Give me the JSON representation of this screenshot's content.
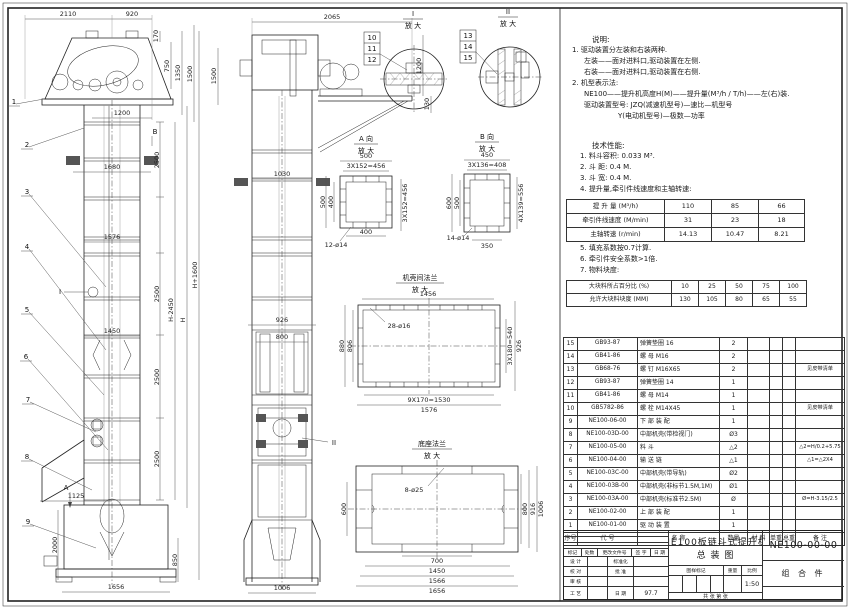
{
  "sheet": {
    "title_line1": "NE100板链斗式提升机",
    "title_line2": "总  装  图",
    "drawing_no": "NE100-00-00",
    "part_type": "组 合 件",
    "scale": "1:50",
    "date": "97.7",
    "sheet_info": "共  张  第  张"
  },
  "labels": {
    "fangda": "放 大",
    "viewA": "A 向",
    "viewB": "B 向",
    "flangeDetail": "机壳间法兰",
    "baseDetail": "底座法兰",
    "secI": "I",
    "secII": "II",
    "lA": "A",
    "lB": "B"
  },
  "callouts": {
    "c1": "1",
    "c2": "2",
    "c3": "3",
    "c4": "4",
    "c5": "5",
    "c6": "6",
    "c7": "7",
    "c8": "8",
    "c9": "9",
    "c10": "10",
    "c11": "11",
    "c12": "12",
    "c13": "13",
    "c14": "14",
    "c15": "15"
  },
  "dims": {
    "d2110": "2110",
    "d920": "920",
    "d170": "170",
    "d750": "750",
    "d1350": "1350",
    "d1500": "1500",
    "d1200": "1200",
    "d1680": "1680",
    "d2500": "2500",
    "d1576": "1576",
    "d1450": "1450",
    "dHm": "H-2450",
    "dH": "H",
    "dHp": "H+1600",
    "d1125": "1125",
    "d2000": "2000",
    "d850": "850",
    "d1656": "1656",
    "d2065": "2065",
    "d130": "130",
    "d1030": "1030",
    "d926": "926",
    "d800": "800",
    "d1006": "1006",
    "d500": "500",
    "d3x152": "3X152=456",
    "d400": "400",
    "d12o14": "12-ø14",
    "d450": "450",
    "d3x136": "3X136=408",
    "d600": "600",
    "d4x139": "4X139=556",
    "d14o14": "14-ø14",
    "d350": "350",
    "d1456": "1456",
    "d28o16": "28-ø16",
    "d880": "880",
    "d806": "806",
    "d3x180": "3X180=540",
    "d9x170": "9X170=1530",
    "d8o25": "8-ø25",
    "d916": "916",
    "d700": "700",
    "d1566": "1566"
  },
  "notes": {
    "heading": "说明:",
    "lines": [
      "1. 驱动装置分左装和右装两种.",
      "左装——面对进料口,驱动装置在左侧.",
      "右装——面对进料口,驱动装置在右侧.",
      "2. 机型表示法:",
      "NE100——提升机高度H(M)——提升量(M³/h / T/h)——左(右)装.",
      "驱动装置型号: JZQ(减速机型号)—速比—机型号",
      "Y(电动机型号)—极数—功率"
    ]
  },
  "specs": {
    "heading": "技术性能:",
    "items_a": [
      "1. 料斗容积: 0.033 M³.",
      "2. 斗  距: 0.4 M.",
      "3. 斗  宽: 0.4 M.",
      "4. 提升量,牵引件线速度和主轴转速:"
    ],
    "items_b": [
      "5. 填充系数按0.7计算.",
      "6. 牵引件安全系数>1倍.",
      "7. 物料块度:"
    ],
    "table1": {
      "rows": [
        [
          "提 升 量 (M³/h)",
          "110",
          "85",
          "66"
        ],
        [
          "牵引件线速度 (M/min)",
          "31",
          "23",
          "18"
        ],
        [
          "主轴转速 (r/min)",
          "14.13",
          "10.47",
          "8.21"
        ]
      ]
    },
    "table2": {
      "rows": [
        [
          "大块料所占百分比 (%)",
          "10",
          "25",
          "50",
          "75",
          "100"
        ],
        [
          "允许大块料块度 (MM)",
          "130",
          "105",
          "80",
          "65",
          "55"
        ]
      ]
    }
  },
  "bom": {
    "headers": [
      "序号",
      "代  号",
      "名  称",
      "数量",
      "材  料",
      "单重",
      "总重",
      "备  注"
    ],
    "rows": [
      {
        "no": "15",
        "code": "GB93-87",
        "name": "弹簧垫圈  16",
        "qty": "2",
        "remark": ""
      },
      {
        "no": "14",
        "code": "GB41-86",
        "name": "螺 母  M16",
        "qty": "2",
        "remark": ""
      },
      {
        "no": "13",
        "code": "GB68-76",
        "name": "螺 钉  M16X65",
        "qty": "2",
        "remark": "见皮带清单"
      },
      {
        "no": "12",
        "code": "GB93-87",
        "name": "弹簧垫圈  14",
        "qty": "1",
        "remark": ""
      },
      {
        "no": "11",
        "code": "GB41-86",
        "name": "螺 母  M14",
        "qty": "1",
        "remark": ""
      },
      {
        "no": "10",
        "code": "GB5782-86",
        "name": "螺 栓  M14X45",
        "qty": "1",
        "remark": "见皮带清单"
      },
      {
        "no": "9",
        "code": "NE100-06-00",
        "name": "下 部 装 配",
        "qty": "1",
        "remark": ""
      },
      {
        "no": "8",
        "code": "NE100-03D-00",
        "name": "中部机壳(带检视门)",
        "qty": "Ø3",
        "remark": ""
      },
      {
        "no": "7",
        "code": "NE100-05-00",
        "name": "料 斗",
        "qty": "△2",
        "remark": "△2=H/0.2+5.75"
      },
      {
        "no": "6",
        "code": "NE100-04-00",
        "name": "输 送 链",
        "qty": "△1",
        "remark": "△1=△2X4"
      },
      {
        "no": "5",
        "code": "NE100-03C-00",
        "name": "中部机壳(带导轨)",
        "qty": "Ø2",
        "remark": ""
      },
      {
        "no": "4",
        "code": "NE100-03B-00",
        "name": "中部机壳(非标节1.5M,1M)",
        "qty": "Ø1",
        "remark": ""
      },
      {
        "no": "3",
        "code": "NE100-03A-00",
        "name": "中部机壳(标准节2.5M)",
        "qty": "Ø",
        "remark": "Ø=H-3.15/2.5"
      },
      {
        "no": "2",
        "code": "NE100-02-00",
        "name": "上 部 装 配",
        "qty": "1",
        "remark": ""
      },
      {
        "no": "1",
        "code": "NE100-01-00",
        "name": "驱 动 装 置",
        "qty": "1",
        "remark": ""
      }
    ]
  },
  "titleblock": {
    "rev_header": [
      "标记",
      "处数",
      "更改文件号",
      "签 字",
      "日 期"
    ],
    "r_design": "设 计",
    "r_check": "校 对",
    "r_audit": "审 核",
    "r_craft": "工 艺",
    "r_std": "标准化",
    "r_approve": "批 准",
    "r_date": "日 期",
    "stamp1": "图样标记",
    "stamp2": "重量",
    "stamp3": "比例"
  }
}
